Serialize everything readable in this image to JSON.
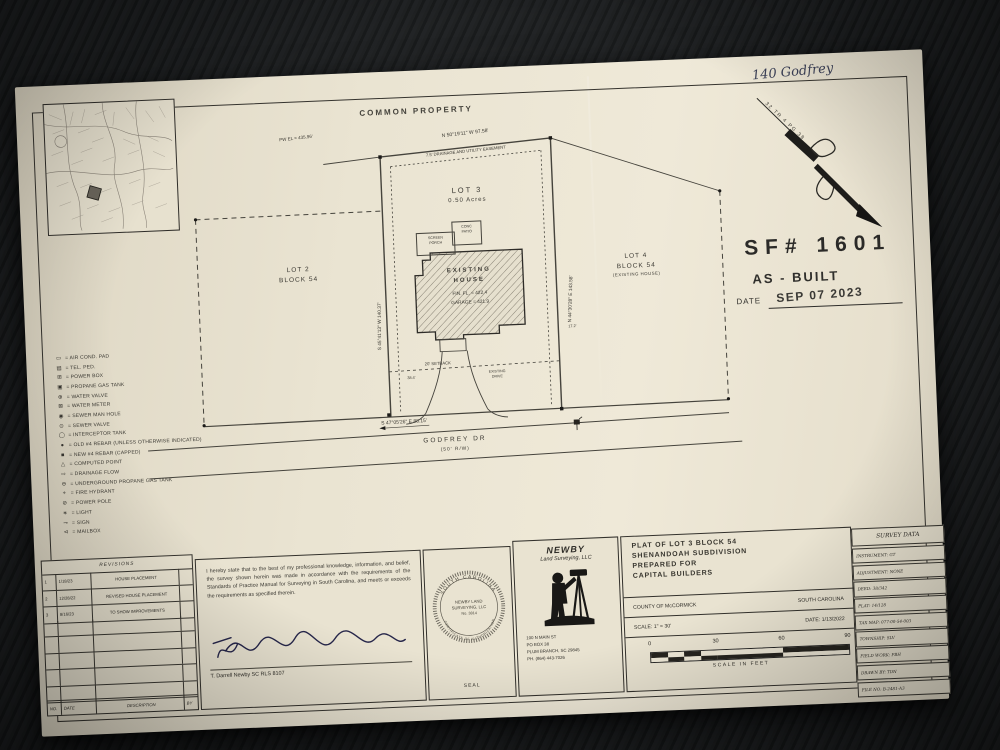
{
  "photo": {
    "handwritten_note": "140 Godfrey"
  },
  "plat": {
    "common_property": "COMMON PROPERTY",
    "north_arrow_note": "32 TR 4 PG 38",
    "stamp": {
      "sf_number": "SF# 1601",
      "as_built": "AS - BUILT",
      "date_label": "DATE",
      "date_value": "SEP 07 2023"
    },
    "bearings": {
      "top": "N 50°19'11\" W   97.58'",
      "left": "S 45°41'13\" W   140.37'",
      "right": "N 44°30'28\" E   143.58'",
      "bottom": "S 47°05'26\" E   88.15'"
    },
    "labels": {
      "pw_el": "PW EL = 435.96'",
      "easement": "7.5' DRAINAGE AND UTILITY EASEMENT",
      "setback": "20' SETBACK",
      "dim_a": "38.4'",
      "dim_b": "17.2'",
      "drive_line1": "EXISTING",
      "drive_line2": "DRIVE",
      "patio_line1": "CONC",
      "patio_line2": "PATIO",
      "porch_line1": "SCREEN",
      "porch_line2": "PORCH"
    },
    "lot3": {
      "name": "LOT 3",
      "area": "0.50 Acres"
    },
    "lot2": {
      "name": "LOT 2",
      "block": "BLOCK 54"
    },
    "lot4": {
      "name": "LOT 4",
      "block": "BLOCK 54",
      "note": "(EXISTING HOUSE)"
    },
    "house": {
      "line1": "EXISTING",
      "line2": "HOUSE",
      "fin_fl": "FIN. FL. = 422.4",
      "garage": "GARAGE = 421.9"
    },
    "road": {
      "name": "GODFREY DR",
      "rw": "(50' R/W)"
    }
  },
  "legend": {
    "items": [
      {
        "symbol": "▭",
        "label": "= AIR COND. PAD"
      },
      {
        "symbol": "▤",
        "label": "= TEL. PED."
      },
      {
        "symbol": "⊞",
        "label": "= POWER BOX"
      },
      {
        "symbol": "▣",
        "label": "= PROPANE GAS TANK"
      },
      {
        "symbol": "⊕",
        "label": "= WATER VALVE"
      },
      {
        "symbol": "⊠",
        "label": "= WATER METER"
      },
      {
        "symbol": "◉",
        "label": "= SEWER MAN HOLE"
      },
      {
        "symbol": "⊙",
        "label": "= SEWER VALVE"
      },
      {
        "symbol": "◯",
        "label": "= INTERCEPTOR TANK"
      },
      {
        "symbol": "●",
        "label": "= OLD #4 REBAR (UNLESS OTHERWISE INDICATED)"
      },
      {
        "symbol": "■",
        "label": "= NEW #4 REBAR (CAPPED)"
      },
      {
        "symbol": "△",
        "label": "= COMPUTED POINT"
      },
      {
        "symbol": "⇨",
        "label": "= DRAINAGE FLOW"
      },
      {
        "symbol": "⊖",
        "label": "= UNDERGROUND PROPANE GAS TANK"
      },
      {
        "symbol": "⌖",
        "label": "= FIRE HYDRANT"
      },
      {
        "symbol": "⊘",
        "label": "= POWER POLE"
      },
      {
        "symbol": "∗",
        "label": "= LIGHT"
      },
      {
        "symbol": "⊸",
        "label": "= SIGN"
      },
      {
        "symbol": "⊲",
        "label": "= MAILBOX"
      }
    ]
  },
  "revisions": {
    "title": "REVISIONS",
    "rows": [
      {
        "no": "1",
        "date": "1/18/23",
        "desc": "HOUSE PLACEMENT",
        "by": ""
      },
      {
        "no": "2",
        "date": "12/28/22",
        "desc": "REVISED HOUSE PLACEMENT",
        "by": ""
      },
      {
        "no": "3",
        "date": "8/16/23",
        "desc": "TO SHOW IMPROVEMENTS",
        "by": ""
      }
    ],
    "footer": {
      "no": "NO.",
      "date": "DATE",
      "desc": "DESCRIPTION",
      "by": "BY"
    }
  },
  "certification": {
    "text": "I hereby state that to the best of my professional knowledge, information, and belief, the survey shown herein was made in accordance with the requirements of the Standards of Practice Manual for Surveying in South Carolina, and meets or exceeds the requirements as specified therein.",
    "signer": "T. Darrell Newby SC RLS 8107"
  },
  "seal": {
    "arc_top": "SOUTH CAROLINA",
    "arc_bottom": "CERTIFICATE OF AUTHORIZATION",
    "center1": "NEWBY LAND",
    "center2": "SURVEYING, LLC",
    "center3": "No. 3814",
    "caption": "SEAL"
  },
  "firm": {
    "name": "NEWBY",
    "name2": "Land Surveying, LLC",
    "address1": "100 N MAIN ST",
    "address2": "PO BOX 38",
    "address3": "PLUM BRANCH, SC 29845",
    "address4": "PH. (864) 443-7026"
  },
  "title_block": {
    "line1": "PLAT OF LOT 3 BLOCK 54",
    "line2": "SHENANDOAH SUBDIVISION",
    "line3": "PREPARED FOR",
    "line4": "CAPITAL BUILDERS",
    "county": "COUNTY OF McCORMICK",
    "state": "SOUTH CAROLINA",
    "scale": "SCALE: 1\" = 30'",
    "date": "DATE: 1/13/2022"
  },
  "scale_bar": {
    "ticks": [
      "0",
      "30",
      "60",
      "90"
    ],
    "caption": "SCALE IN FEET"
  },
  "survey_data": {
    "title": "SURVEY DATA",
    "rows": [
      "INSTRUMENT:  GT",
      "ADJUSTMENT:  NONE",
      "DEED:  38/342",
      "PLAT:  14/128",
      "TAX MAP:  077-00-54-003",
      "TOWNSHIP:  SLV",
      "FIELD WORK:  FBH",
      "DRAWN BY:  TDN",
      "FILE NO:  B-2481-A3"
    ]
  }
}
